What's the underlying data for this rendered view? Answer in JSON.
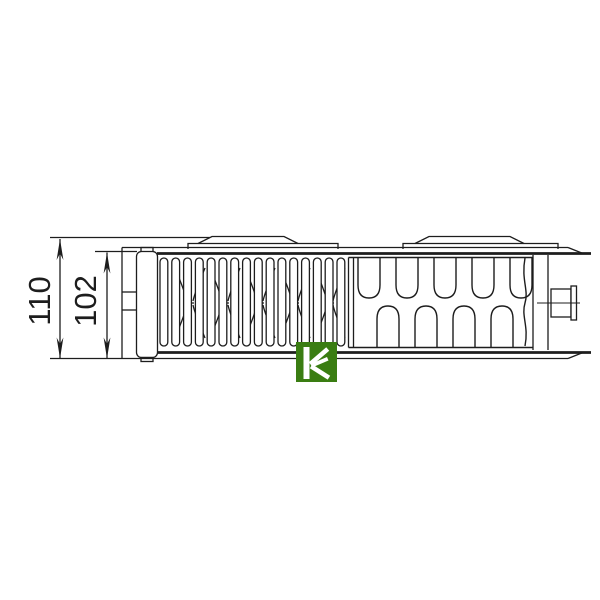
{
  "page": {
    "background": "#ffffff"
  },
  "diagram": {
    "type": "radiator-side-profile-technical-drawing",
    "line_color": "#1d1d1d",
    "dimensions": [
      {
        "id": "overall-depth",
        "label": "110"
      },
      {
        "id": "panel-depth",
        "label": "102"
      }
    ],
    "radiator": {
      "fin_count": 16,
      "hourglass_count": 5,
      "top_wave_count": 5,
      "bottom_wave_count": 4
    },
    "logo": {
      "letter": "K",
      "background": "#3a7d12",
      "glyph_color": "#ffffff"
    }
  }
}
